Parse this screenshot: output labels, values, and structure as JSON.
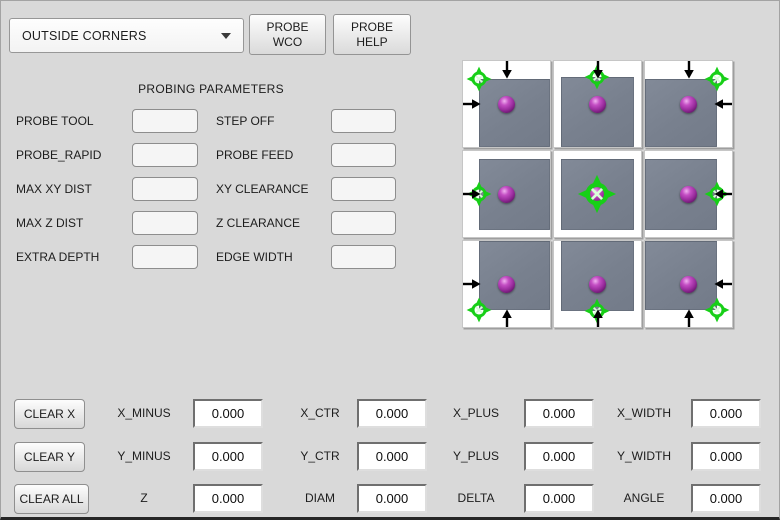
{
  "header": {
    "mode_select": {
      "value": "OUTSIDE CORNERS"
    },
    "probe_wco_button": {
      "line1": "PROBE",
      "line2": "WCO"
    },
    "probe_help_button": {
      "line1": "PROBE",
      "line2": "HELP"
    }
  },
  "params": {
    "title": "PROBING PARAMETERS",
    "rows": [
      {
        "left": "PROBE TOOL",
        "right": "STEP OFF"
      },
      {
        "left": "PROBE_RAPID",
        "right": "PROBE FEED"
      },
      {
        "left": "MAX XY DIST",
        "right": "XY CLEARANCE"
      },
      {
        "left": "MAX Z DIST",
        "right": "Z CLEARANCE"
      },
      {
        "left": "EXTRA DEPTH",
        "right": "EDGE WIDTH"
      }
    ],
    "input_value": ""
  },
  "probe_grid": {
    "tiles": [
      {
        "pos": "nw",
        "name": "top-left-corner",
        "arrows": [
          "down",
          "right"
        ]
      },
      {
        "pos": "n",
        "name": "top-edge",
        "arrows": [
          "down"
        ]
      },
      {
        "pos": "ne",
        "name": "top-right-corner",
        "arrows": [
          "down",
          "left"
        ]
      },
      {
        "pos": "w",
        "name": "left-edge",
        "arrows": [
          "right"
        ]
      },
      {
        "pos": "c",
        "name": "center",
        "arrows": []
      },
      {
        "pos": "e",
        "name": "right-edge",
        "arrows": [
          "left"
        ]
      },
      {
        "pos": "sw",
        "name": "bottom-left-corner",
        "arrows": [
          "right",
          "up"
        ]
      },
      {
        "pos": "s",
        "name": "bottom-edge",
        "arrows": [
          "up"
        ]
      },
      {
        "pos": "se",
        "name": "bottom-right-corner",
        "arrows": [
          "left",
          "up"
        ]
      }
    ],
    "colors": {
      "target_green": "#17cf17",
      "workpiece_gray": "#78808e",
      "ball_purple": "#9a2d9e",
      "arrow_black": "#000000"
    }
  },
  "results": {
    "buttons": [
      "CLEAR X",
      "CLEAR Y",
      "CLEAR ALL"
    ],
    "rows": [
      {
        "fields": [
          {
            "label": "X_MINUS",
            "value": "0.000"
          },
          {
            "label": "X_CTR",
            "value": "0.000"
          },
          {
            "label": "X_PLUS",
            "value": "0.000"
          },
          {
            "label": "X_WIDTH",
            "value": "0.000"
          }
        ]
      },
      {
        "fields": [
          {
            "label": "Y_MINUS",
            "value": "0.000"
          },
          {
            "label": "Y_CTR",
            "value": "0.000"
          },
          {
            "label": "Y_PLUS",
            "value": "0.000"
          },
          {
            "label": "Y_WIDTH",
            "value": "0.000"
          }
        ]
      },
      {
        "fields": [
          {
            "label": "Z",
            "value": "0.000"
          },
          {
            "label": "DIAM",
            "value": "0.000"
          },
          {
            "label": "DELTA",
            "value": "0.000"
          },
          {
            "label": "ANGLE",
            "value": "0.000"
          }
        ]
      }
    ]
  }
}
